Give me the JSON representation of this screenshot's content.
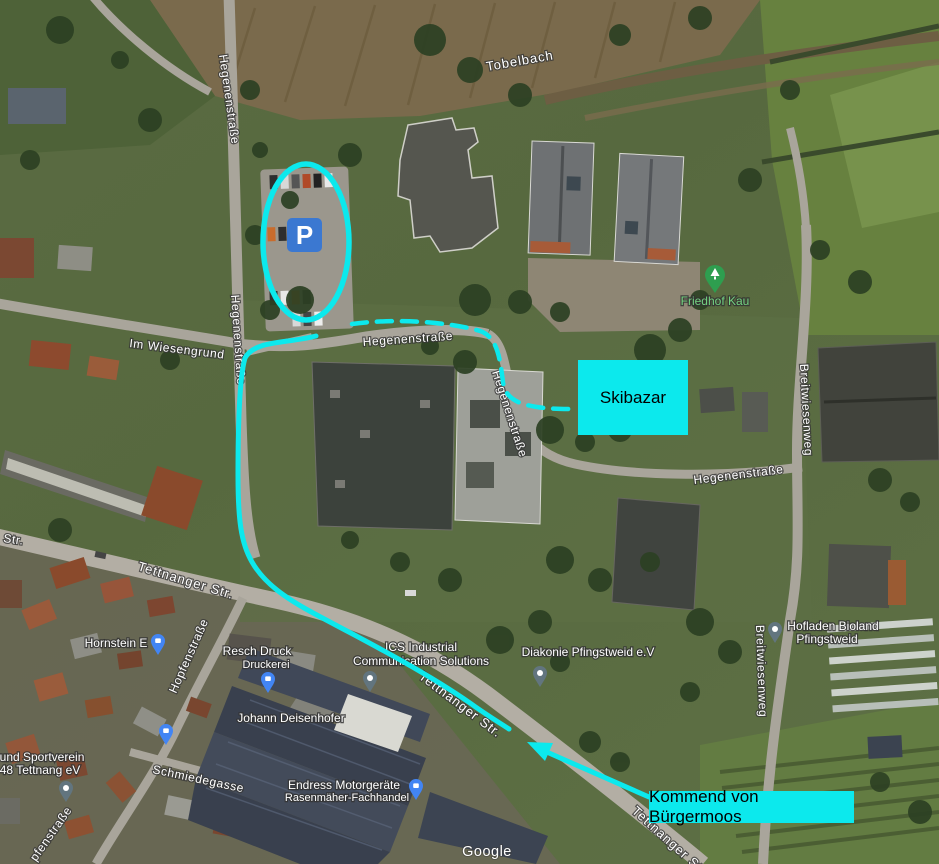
{
  "map": {
    "watermark": "Google",
    "streets": {
      "hegenen_nw": "Hegenenstraße",
      "hegenen_w2": "Hegenenstraße",
      "hegenen_c": "Hegenenstraße",
      "hegenen_curve": "Hegenenstraße",
      "hegenen_e": "Hegenenstraße",
      "tobelbach": "Tobelbach",
      "im_wiesengrund": "Im Wiesengrund",
      "breitwiesen_n": "Breitwiesenweg",
      "breitwiesen_s": "Breitwiesenweg",
      "tettnanger_w": "Tettnanger Str.",
      "tettnanger_c": "Tettnanger Str.",
      "tettnanger_s": "Tettnanger Str.",
      "hopfen": "Hopfenstraße",
      "schmiede": "Schmiedegasse",
      "str_partial": "Str.",
      "pfen_partial": "pfenstraße"
    },
    "pois": {
      "friedhof": "Friedhof Kau",
      "hornstein": "Hornstein E",
      "resch1": "Resch Druck",
      "resch2": "Druckerei",
      "johann": "Johann Deisenhofer",
      "ics1": "ICS Industrial",
      "ics2": "Communication Solutions",
      "diakonie": "Diakonie Pfingstweid e.V",
      "hofladen1": "Hofladen Bioland",
      "hofladen2": "Pfingstweid",
      "endress1": "Endress Motorgeräte",
      "endress2": "Rasenmäher-Fachhandel",
      "sport1": "und Sportverein",
      "sport2": "48 Tettnang eV"
    },
    "icons": {
      "shopping_pin": "shopping-pin-icon",
      "place_pin": "place-pin-icon",
      "tree_pin": "tree-pin-icon"
    }
  },
  "annotations": {
    "skibazar_label": "Skibazar",
    "kommend_label": "Kommend von Bürgermoos",
    "parking_letter": "P",
    "colors": {
      "highlight_cyan": "#0ce9ed",
      "parking_icon_blue": "#3b78d1",
      "shopping_pin_blue": "#4285f4",
      "place_pin_gray": "#7a8a95",
      "friedhof_green": "#34a853"
    }
  }
}
